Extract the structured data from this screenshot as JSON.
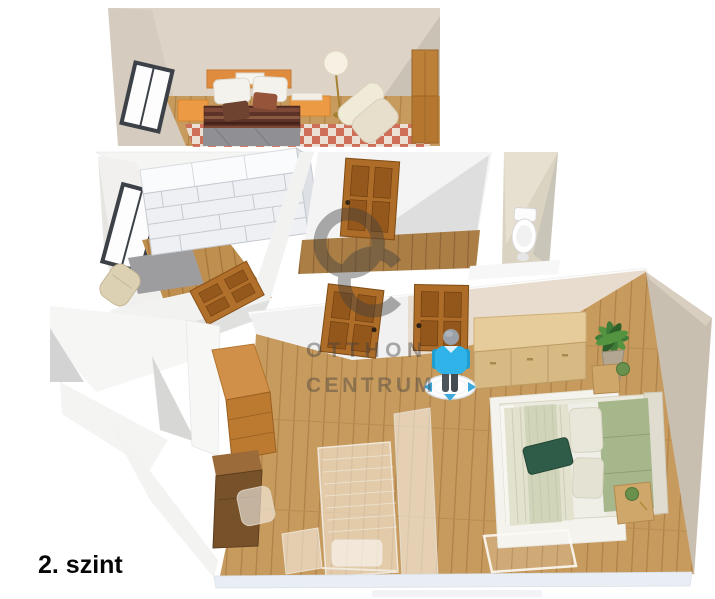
{
  "floor_label": "2. szint",
  "watermark": {
    "monogram": "OC",
    "line1": "OTTHON",
    "line2": "CENTRUM"
  },
  "palette": {
    "background": "#ffffff",
    "wall_beige": "#ddd3c6",
    "wall_beige_dark": "#c9bfb1",
    "wall_white": "#f3f3f3",
    "wall_shadow_gray": "#d7d7d6",
    "floor_wood": "#c79a5e",
    "floor_wood_dark": "#aa7e45",
    "door_wood": "#ad6d29",
    "bed_frame_orange": "#ec9a44",
    "blanket_brown": "#5e3327",
    "quilt_gray": "#908f93",
    "rug_checker_red": "#cf6b58",
    "closet_shelf_white": "#eef0f3",
    "wc_tile": "#dbd3c2",
    "bed_green_pillow": "#a7b78c",
    "bed_green_cushion": "#2e5c49",
    "sideboard_wood": "#e6cb9b",
    "plant_green": "#3e7c38",
    "figure_shirt_blue": "#2fb3e8",
    "figure_pants_gray": "#4e545c",
    "marker_arrow_blue": "#3fa9dc",
    "watermark_gray": "#3f3f3f",
    "bottom_wall_tint": "#e9eef5"
  },
  "rooms": [
    {
      "name": "bedroom-top"
    },
    {
      "name": "walk-in-closet"
    },
    {
      "name": "hallway"
    },
    {
      "name": "wc"
    },
    {
      "name": "bedroom-main"
    },
    {
      "name": "study-area"
    },
    {
      "name": "staircase-void"
    }
  ]
}
